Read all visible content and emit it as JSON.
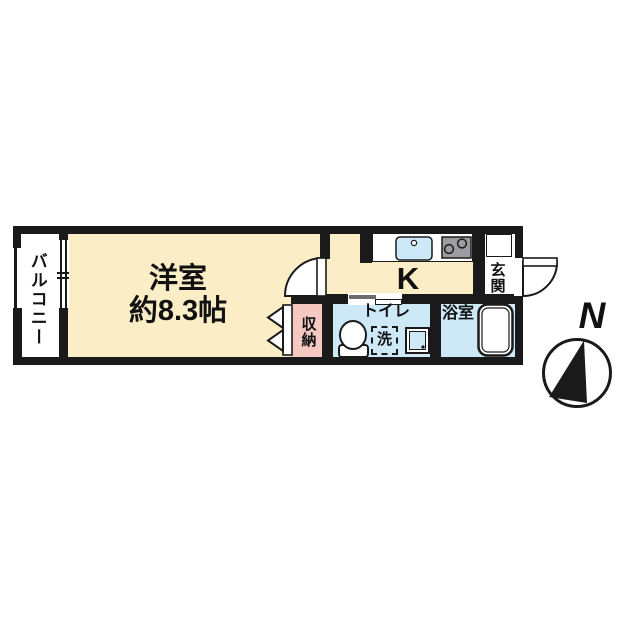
{
  "floorplan": {
    "balcony_label": "バルコニー",
    "main_room_label": "洋室",
    "main_room_size": "約8.3帖",
    "kitchen_label": "K",
    "entrance_label": "玄関",
    "storage_label": "収納",
    "toilet_label": "トイレ",
    "laundry_label": "洗",
    "bathroom_label": "浴室",
    "compass_label": "N"
  },
  "colors": {
    "wall": "#1a1a1a",
    "room_cream": "#FBEDC5",
    "storage_pink": "#F6C8C2",
    "wet_area_blue": "#CDE8F6",
    "stove_gray": "#9D9DA1",
    "fixture_white": "#ffffff"
  }
}
